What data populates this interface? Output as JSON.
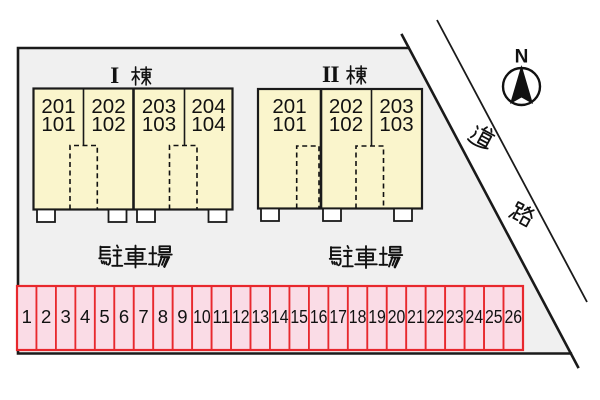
{
  "buildings": [
    {
      "label": "Ⅰ棟",
      "numeral": "I",
      "kanji": "棟",
      "sections": [
        {
          "upper": "201",
          "lower": "101"
        },
        {
          "upper": "202",
          "lower": "102"
        },
        {
          "upper": "203",
          "lower": "103"
        },
        {
          "upper": "204",
          "lower": "104"
        }
      ]
    },
    {
      "label": "Ⅱ棟",
      "numeral": "II",
      "kanji": "棟",
      "sections": [
        {
          "upper": "201",
          "lower": "101"
        },
        {
          "upper": "202",
          "lower": "102"
        },
        {
          "upper": "203",
          "lower": "103"
        }
      ]
    }
  ],
  "parking_areas": [
    {
      "label": "駐車場"
    },
    {
      "label": "駐車場"
    }
  ],
  "parking_row": {
    "spaces": [
      "1",
      "2",
      "3",
      "4",
      "5",
      "6",
      "7",
      "8",
      "9",
      "10",
      "11",
      "12",
      "13",
      "14",
      "15",
      "16",
      "17",
      "18",
      "19",
      "20",
      "21",
      "22",
      "23",
      "24",
      "25",
      "26"
    ],
    "fill": "#fadce6",
    "border_color": "#e8282d"
  },
  "road": {
    "label": "道路",
    "char_1": "道",
    "char_2": "路"
  },
  "compass": {
    "north_label": "N"
  },
  "colors": {
    "background": "#ffffff",
    "site_fill": "#f0f0f0",
    "building_fill": "#faf5cc",
    "line": "#1a1a1a",
    "parking_fill": "#fadce6",
    "parking_border": "#e8282d"
  }
}
